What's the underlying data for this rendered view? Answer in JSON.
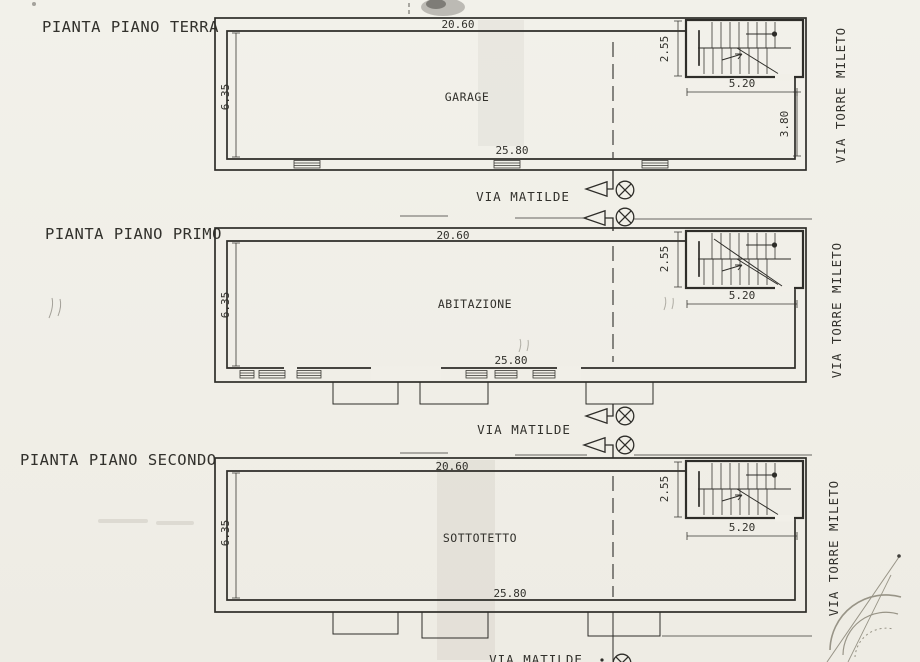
{
  "colors": {
    "paper": "#f1efe8",
    "ink": "#2e2d29"
  },
  "plans": [
    {
      "title": "PIANTA PIANO TERRA",
      "room_label": "GARAGE",
      "dims": {
        "top_width": "20.60",
        "left_height": "6.35",
        "bottom_width": "25.80",
        "stair_depth": "2.55",
        "stair_width": "5.20",
        "right_depth": "3.80"
      },
      "street_right": "VIA TORRE MILETO",
      "street_bottom": "VIA MATILDE"
    },
    {
      "title": "PIANTA PIANO PRIMO",
      "room_label": "ABITAZIONE",
      "dims": {
        "top_width": "20.60",
        "left_height": "6.35",
        "bottom_width": "25.80",
        "stair_depth": "2.55",
        "stair_width": "5.20"
      },
      "street_right": "VIA TORRE MILETO",
      "street_bottom": "VIA MATILDE"
    },
    {
      "title": "PIANTA PIANO SECONDO",
      "room_label": "SOTTOTETTO",
      "dims": {
        "top_width": "20.60",
        "left_height": "6.35",
        "bottom_width": "25.80",
        "stair_depth": "2.55",
        "stair_width": "5.20"
      },
      "street_right": "VIA TORRE MILETO",
      "street_bottom": "VIA MATILDE"
    }
  ]
}
